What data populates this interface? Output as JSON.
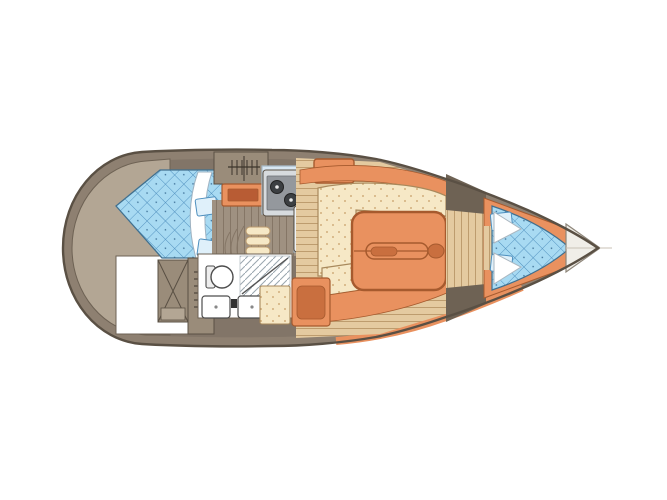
{
  "diagram": {
    "type": "yacht-interior-floor-plan",
    "view": "top-down",
    "orientation": "bow-right",
    "compartments": [
      {
        "name": "stern-deck"
      },
      {
        "name": "aft-cabin-double-berth"
      },
      {
        "name": "aft-storage-lockers"
      },
      {
        "name": "head-with-shower"
      },
      {
        "name": "galley"
      },
      {
        "name": "companionway"
      },
      {
        "name": "saloon"
      },
      {
        "name": "forward-v-berth"
      },
      {
        "name": "anchor-locker"
      }
    ],
    "fixtures": [
      "double-berth-mattress",
      "berth-pillows",
      "berth-blanket",
      "x-brace-locker",
      "hanging-rail-icon",
      "toilet",
      "twin-washbasins",
      "shower-panel",
      "two-burner-stove",
      "icebox-counter",
      "double-sink",
      "companionway-steps",
      "saloon-table",
      "settee-cushions",
      "nav-seat",
      "v-berth-pillows",
      "bow-anchor-locker"
    ]
  },
  "colors": {
    "outline": "#5a5044",
    "hull-band": "#8e8071",
    "stern-cap": "#b3a694",
    "wall": "#827568",
    "wall-line": "#6e6254",
    "locker": "#9a8c7a",
    "bed-blue": "#a8daf2",
    "bed-grid": "#4e8fbe",
    "bed-edge": "#41708f",
    "orange": "#e9915f",
    "orange-dark": "#c96f3f",
    "orange-line": "#a65a2e",
    "cream": "#f6e8c6",
    "speck-dot": "#c69e67",
    "wood": "#e4caa0",
    "wood-line": "#bd9c6e",
    "floor-gray": "#9f9181",
    "floor-gray-line": "#857666",
    "counter": "#d9e7f2",
    "counter-line": "#a9bcca",
    "stove-body": "#d7dbde",
    "stove-panel": "#94989d",
    "burner": "#3c3f42",
    "white": "#ffffff",
    "fixture-line": "#4d4d4d",
    "bow-fill": "#f0eee8",
    "bow-line": "#8d8579",
    "shower-line": "#9aa6ae",
    "pillow-fill": "#dff0fa"
  }
}
